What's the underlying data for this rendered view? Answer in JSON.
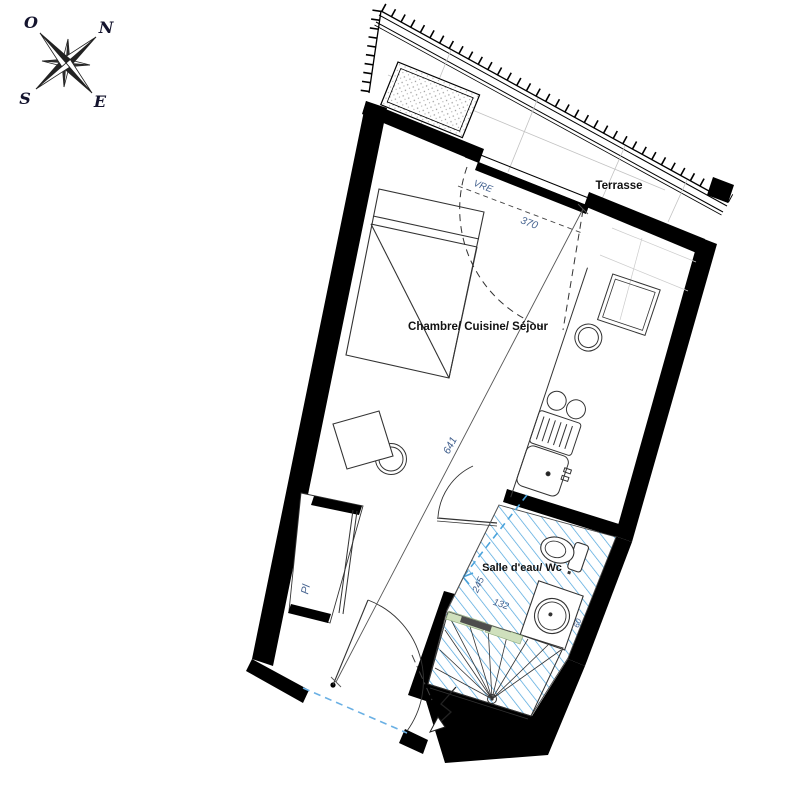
{
  "compass": {
    "letters": {
      "n": "N",
      "o": "O",
      "s": "S",
      "e": "E"
    }
  },
  "labels": {
    "terrace": "Terrasse",
    "main_room": "Chambre/ Cuisine/ Séjour",
    "bathroom": "Salle d'eau/ Wc",
    "closet": "Pl",
    "shutter": "VRE"
  },
  "dimensions": {
    "bay_width": "370",
    "room_length": "641",
    "bath_length": "245",
    "bath_width": "132",
    "basin": "60"
  },
  "colors": {
    "walls": "#000000",
    "hatch_blue": "#4aa3dc",
    "dimension_text": "#44628f",
    "opening_dashed_blue": "#6ab0e4",
    "shower_strip_green": "#cfe0bd",
    "background": "#ffffff"
  }
}
